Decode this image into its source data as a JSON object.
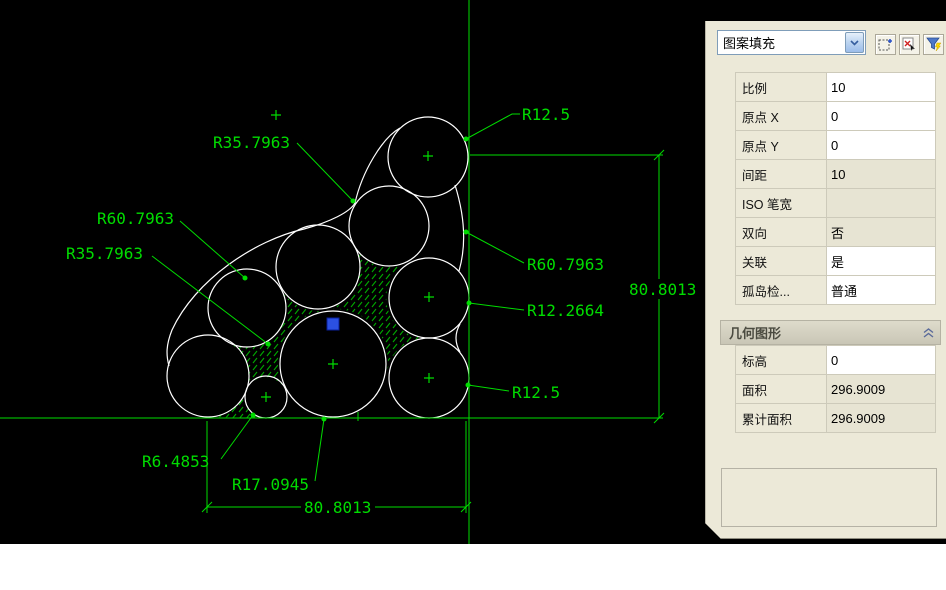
{
  "palette": {
    "selector": {
      "value": "图案填充"
    },
    "toolbar": {
      "icons": [
        {
          "name": "pickadd-toggle"
        },
        {
          "name": "select-objects"
        },
        {
          "name": "quick-select"
        }
      ]
    },
    "hatch_properties": {
      "rows": [
        {
          "label": "比例",
          "value": "10"
        },
        {
          "label": "原点 X",
          "value": "0"
        },
        {
          "label": "原点 Y",
          "value": "0"
        },
        {
          "label": "间距",
          "value": "10"
        },
        {
          "label": "ISO 笔宽",
          "value": ""
        },
        {
          "label": "双向",
          "value": "否"
        },
        {
          "label": "关联",
          "value": "是"
        },
        {
          "label": "孤岛检...",
          "value": "普通"
        }
      ]
    },
    "geometry_section": {
      "title": "几何图形",
      "rows": [
        {
          "label": "标高",
          "value": "0"
        },
        {
          "label": "面积",
          "value": "296.9009"
        },
        {
          "label": "累计面积",
          "value": "296.9009"
        }
      ]
    }
  },
  "drawing": {
    "colors": {
      "line_green": "#00dc00",
      "hatch_green": "#00a800",
      "entity_white": "#ffffff",
      "grip_blue": "#2b50e2",
      "background": "#000000"
    },
    "radius_labels": [
      {
        "text": "R35.7963"
      },
      {
        "text": "R12.5"
      },
      {
        "text": "R60.7963"
      },
      {
        "text": "R35.7963"
      },
      {
        "text": "R60.7963"
      },
      {
        "text": "R12.2664"
      },
      {
        "text": "R12.5"
      },
      {
        "text": "R6.4853"
      },
      {
        "text": "R17.0945"
      }
    ],
    "dimensions": {
      "right_vertical": {
        "text": "80.8013"
      },
      "bottom_horizontal": {
        "text": "80.8013"
      }
    }
  }
}
